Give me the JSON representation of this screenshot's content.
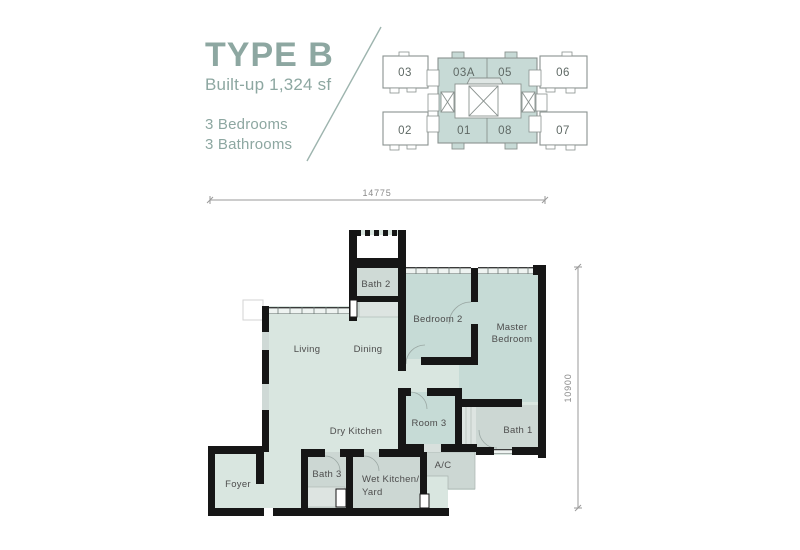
{
  "title": {
    "name": "TYPE B",
    "builtup": "Built-up 1,324 sf",
    "bedrooms": "3 Bedrooms",
    "bathrooms": "3 Bathrooms",
    "accent_color": "#8da7a1"
  },
  "key_plan": {
    "highlight_color": "#c7dad6",
    "outline_color": "#8a928f",
    "units": [
      {
        "label": "03",
        "highlighted": false
      },
      {
        "label": "03A",
        "highlighted": true
      },
      {
        "label": "05",
        "highlighted": true
      },
      {
        "label": "06",
        "highlighted": false
      },
      {
        "label": "02",
        "highlighted": false
      },
      {
        "label": "01",
        "highlighted": true
      },
      {
        "label": "08",
        "highlighted": true
      },
      {
        "label": "07",
        "highlighted": false
      }
    ]
  },
  "floor_plan": {
    "dimensions": {
      "width": "14775",
      "height": "10900"
    },
    "rooms": {
      "living": "Living",
      "dining": "Dining",
      "dry_kitchen": "Dry Kitchen",
      "bath2": "Bath 2",
      "bedroom2": "Bedroom 2",
      "master_line1": "Master",
      "master_line2": "Bedroom",
      "room3": "Room 3",
      "bath1": "Bath 1",
      "ac": "A/C",
      "wet_kitchen_line1": "Wet Kitchen/",
      "wet_kitchen_line2": "Yard",
      "bath3": "Bath 3",
      "foyer": "Foyer"
    },
    "colors": {
      "living_areas": "#d9e6e0",
      "bedrooms": "#c6dbd6",
      "wet_areas": "#ccd7d3",
      "walls": "#161616"
    }
  }
}
